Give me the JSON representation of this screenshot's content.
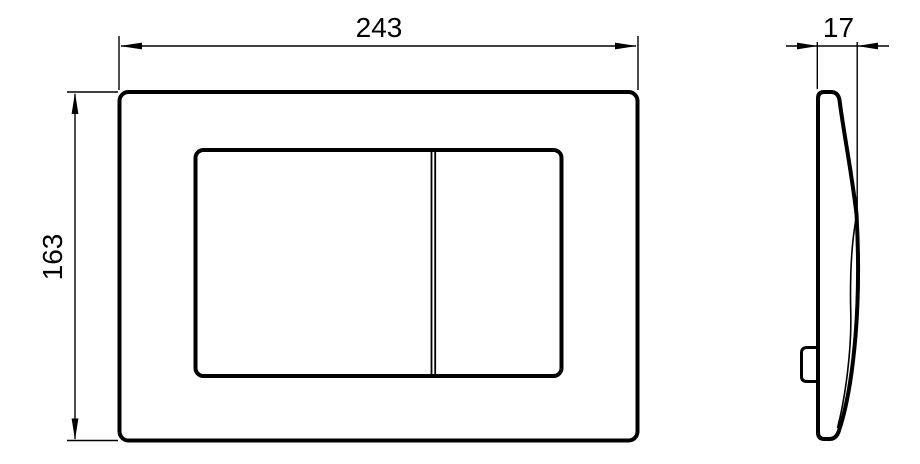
{
  "front_view": {
    "width_dimension": {
      "label": "243",
      "value_mm": 243
    },
    "height_dimension": {
      "label": "163",
      "value_mm": 163
    }
  },
  "side_view": {
    "thickness_dimension": {
      "label": "17",
      "value_mm": 17
    }
  },
  "colors": {
    "line": "#000000",
    "background": "#ffffff"
  }
}
